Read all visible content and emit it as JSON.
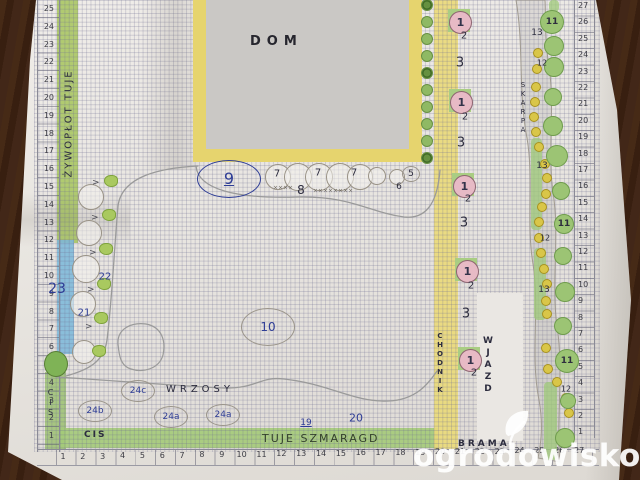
{
  "scene": "hand-drawn garden plan on graph paper photographed on a wooden table",
  "labels": {
    "dom": "DOM",
    "wrzosy": "WRZOSY",
    "cis_strip": "CIS",
    "tuje_strip": "TUJE  SZMARAGD",
    "hedge_left": "ŻYWOPŁOT  TUJE",
    "cis_vertical": "CIS",
    "chodnik": "CHODNIK",
    "wjazd": "WJAZD",
    "skarpa": "SKARPA",
    "brama": "BRAMA"
  },
  "watermark": {
    "text": "ogrodowisko",
    "tld": ".pl"
  },
  "colors": {
    "blue": "#2e3d96",
    "ink": "#2c2c3e",
    "pencil": "#9a948a",
    "pencil2": "#6f6b63",
    "green": "#9cc474",
    "yellow": "#e6d46e",
    "pink": "#e7bac5",
    "paper": "#e9e6e1",
    "wood": "#42281a"
  },
  "rulers": {
    "left": [
      "25",
      "24",
      "23",
      "22",
      "21",
      "20",
      "19",
      "18",
      "17",
      "16",
      "15",
      "14",
      "13",
      "12",
      "11",
      "10",
      "9",
      "8",
      "7",
      "6",
      "5",
      "4",
      "3",
      "2",
      "1"
    ],
    "bottom": [
      "1",
      "2",
      "3",
      "4",
      "5",
      "6",
      "7",
      "8",
      "9",
      "10",
      "11",
      "12",
      "13",
      "14",
      "15",
      "16",
      "17",
      "18",
      "19",
      "20",
      "21",
      "22",
      "23",
      "24",
      "25",
      "26",
      "27"
    ],
    "right": [
      "27",
      "26",
      "25",
      "24",
      "23",
      "22",
      "21",
      "20",
      "19",
      "18",
      "17",
      "16",
      "15",
      "14",
      "13",
      "12",
      "11",
      "10",
      "9",
      "8",
      "7",
      "6",
      "5",
      "4",
      "3",
      "2",
      "1"
    ]
  },
  "annotations": [
    {
      "t": "9",
      "x": 229,
      "y": 179,
      "s": 16,
      "c": "blue",
      "oval": [
        31,
        18
      ],
      "oc": "blue",
      "u": true
    },
    {
      "t": "10",
      "x": 268,
      "y": 327,
      "s": 12,
      "c": "blue",
      "oval": [
        26,
        18
      ],
      "oc": "pencil"
    },
    {
      "t": "19",
      "x": 306,
      "y": 423,
      "s": 9,
      "c": "blue",
      "u": true
    },
    {
      "t": "20",
      "x": 356,
      "y": 418,
      "s": 11,
      "c": "blue"
    },
    {
      "t": "21",
      "x": 84,
      "y": 313,
      "s": 10,
      "c": "blue"
    },
    {
      "t": "22",
      "x": 105,
      "y": 277,
      "s": 10,
      "c": "blue"
    },
    {
      "t": "23",
      "x": 57,
      "y": 289,
      "s": 14,
      "c": "blue"
    },
    {
      "t": "24c",
      "x": 138,
      "y": 391,
      "s": 9,
      "c": "blue",
      "oval": [
        16,
        10
      ],
      "oc": "pencil"
    },
    {
      "t": "24b",
      "x": 95,
      "y": 411,
      "s": 9,
      "c": "blue",
      "oval": [
        16,
        10
      ],
      "oc": "pencil"
    },
    {
      "t": "24a",
      "x": 171,
      "y": 417,
      "s": 9,
      "c": "blue",
      "oval": [
        16,
        10
      ],
      "oc": "pencil"
    },
    {
      "t": "24a",
      "x": 223,
      "y": 415,
      "s": 9,
      "c": "blue",
      "oval": [
        16,
        10
      ],
      "oc": "pencil"
    },
    {
      "t": "7",
      "x": 277,
      "y": 174,
      "s": 10,
      "c": "ink"
    },
    {
      "t": "7",
      "x": 318,
      "y": 173,
      "s": 10,
      "c": "ink"
    },
    {
      "t": "7",
      "x": 354,
      "y": 173,
      "s": 10,
      "c": "ink"
    },
    {
      "t": "8",
      "x": 301,
      "y": 190,
      "s": 12,
      "c": "ink"
    },
    {
      "t": "6",
      "x": 399,
      "y": 187,
      "s": 9,
      "c": "ink"
    },
    {
      "t": "5",
      "x": 411,
      "y": 174,
      "s": 9,
      "c": "ink",
      "oval": [
        8,
        7
      ],
      "oc": "pencil"
    },
    {
      "t": "××××",
      "x": 283,
      "y": 188,
      "s": 6,
      "c": "pencil2"
    },
    {
      "t": "××××××××",
      "x": 333,
      "y": 191,
      "s": 6,
      "c": "pencil2"
    },
    {
      "t": "3",
      "x": 460,
      "y": 63,
      "s": 13,
      "c": "ink"
    },
    {
      "t": "3",
      "x": 461,
      "y": 143,
      "s": 13,
      "c": "ink"
    },
    {
      "t": "3",
      "x": 464,
      "y": 223,
      "s": 13,
      "c": "ink"
    },
    {
      "t": "3",
      "x": 466,
      "y": 314,
      "s": 13,
      "c": "ink"
    },
    {
      "t": "2",
      "x": 464,
      "y": 36,
      "s": 10,
      "c": "ink"
    },
    {
      "t": "2",
      "x": 465,
      "y": 117,
      "s": 10,
      "c": "ink"
    },
    {
      "t": "2",
      "x": 468,
      "y": 199,
      "s": 10,
      "c": "ink"
    },
    {
      "t": "2",
      "x": 471,
      "y": 286,
      "s": 10,
      "c": "ink"
    },
    {
      "t": "2",
      "x": 474,
      "y": 373,
      "s": 10,
      "c": "ink"
    },
    {
      "t": "13",
      "x": 537,
      "y": 33,
      "s": 9,
      "c": "ink"
    },
    {
      "t": "13",
      "x": 542,
      "y": 166,
      "s": 9,
      "c": "ink"
    },
    {
      "t": "13",
      "x": 544,
      "y": 290,
      "s": 9,
      "c": "ink"
    },
    {
      "t": "12",
      "x": 542,
      "y": 63,
      "s": 8,
      "c": "ink"
    },
    {
      "t": "12",
      "x": 545,
      "y": 238,
      "s": 8,
      "c": "ink"
    },
    {
      "t": "12",
      "x": 566,
      "y": 389,
      "s": 8,
      "c": "ink"
    }
  ],
  "markers": {
    "left_bed": {
      "outlines": [
        [
          90,
          196,
          12
        ],
        [
          88,
          232,
          12
        ],
        [
          85,
          268,
          13
        ],
        [
          82,
          303,
          12
        ],
        [
          83,
          351,
          11
        ]
      ],
      "blobs": [
        [
          110,
          180
        ],
        [
          108,
          214
        ],
        [
          105,
          248
        ],
        [
          103,
          283
        ],
        [
          100,
          317
        ],
        [
          98,
          350
        ]
      ],
      "arrows": [
        [
          96,
          183
        ],
        [
          95,
          218
        ],
        [
          93,
          253
        ],
        [
          91,
          290
        ],
        [
          89,
          327
        ]
      ]
    },
    "row_circles": [
      [
        277,
        176,
        12
      ],
      [
        297,
        176,
        13
      ],
      [
        318,
        176,
        13
      ],
      [
        339,
        176,
        13
      ],
      [
        359,
        176,
        12
      ],
      [
        376,
        175,
        8
      ],
      [
        396,
        176,
        7
      ]
    ],
    "house_dots": {
      "x": 426,
      "ys": [
        4,
        21,
        38,
        55,
        72,
        89,
        106,
        123,
        140,
        157
      ],
      "swirl": [
        0,
        4,
        9
      ]
    },
    "pink_units": [
      [
        459,
        21
      ],
      [
        460,
        101
      ],
      [
        463,
        185
      ],
      [
        466,
        270
      ],
      [
        469,
        359
      ]
    ],
    "skarpa": {
      "segments": [
        [
          549,
          0,
          10,
          12
        ],
        [
          531,
          138,
          11,
          92
        ],
        [
          534,
          248,
          12,
          72
        ],
        [
          544,
          382,
          13,
          78
        ]
      ],
      "dots": [
        [
          537,
          52
        ],
        [
          536,
          68
        ],
        [
          535,
          86
        ],
        [
          534,
          101
        ],
        [
          533,
          116
        ],
        [
          535,
          131
        ],
        [
          538,
          146
        ],
        [
          544,
          163
        ],
        [
          546,
          177
        ],
        [
          545,
          193
        ],
        [
          541,
          206
        ],
        [
          538,
          221
        ],
        [
          538,
          237
        ],
        [
          540,
          252
        ],
        [
          543,
          268
        ],
        [
          546,
          283
        ],
        [
          545,
          300
        ],
        [
          546,
          313
        ],
        [
          545,
          347
        ],
        [
          547,
          368
        ],
        [
          556,
          381
        ],
        [
          565,
          397
        ],
        [
          568,
          412
        ]
      ],
      "circles": [
        [
          551,
          21,
          11,
          "11"
        ],
        [
          553,
          45,
          9,
          ""
        ],
        [
          553,
          66,
          9,
          ""
        ],
        [
          552,
          96,
          8,
          ""
        ],
        [
          552,
          125,
          9,
          ""
        ],
        [
          556,
          155,
          10,
          ""
        ],
        [
          560,
          190,
          8,
          ""
        ],
        [
          563,
          223,
          9,
          "11"
        ],
        [
          562,
          255,
          8,
          ""
        ],
        [
          564,
          291,
          9,
          ""
        ],
        [
          562,
          325,
          8,
          ""
        ],
        [
          566,
          360,
          11,
          "11"
        ],
        [
          567,
          400,
          7,
          ""
        ],
        [
          564,
          437,
          9,
          ""
        ]
      ]
    }
  }
}
